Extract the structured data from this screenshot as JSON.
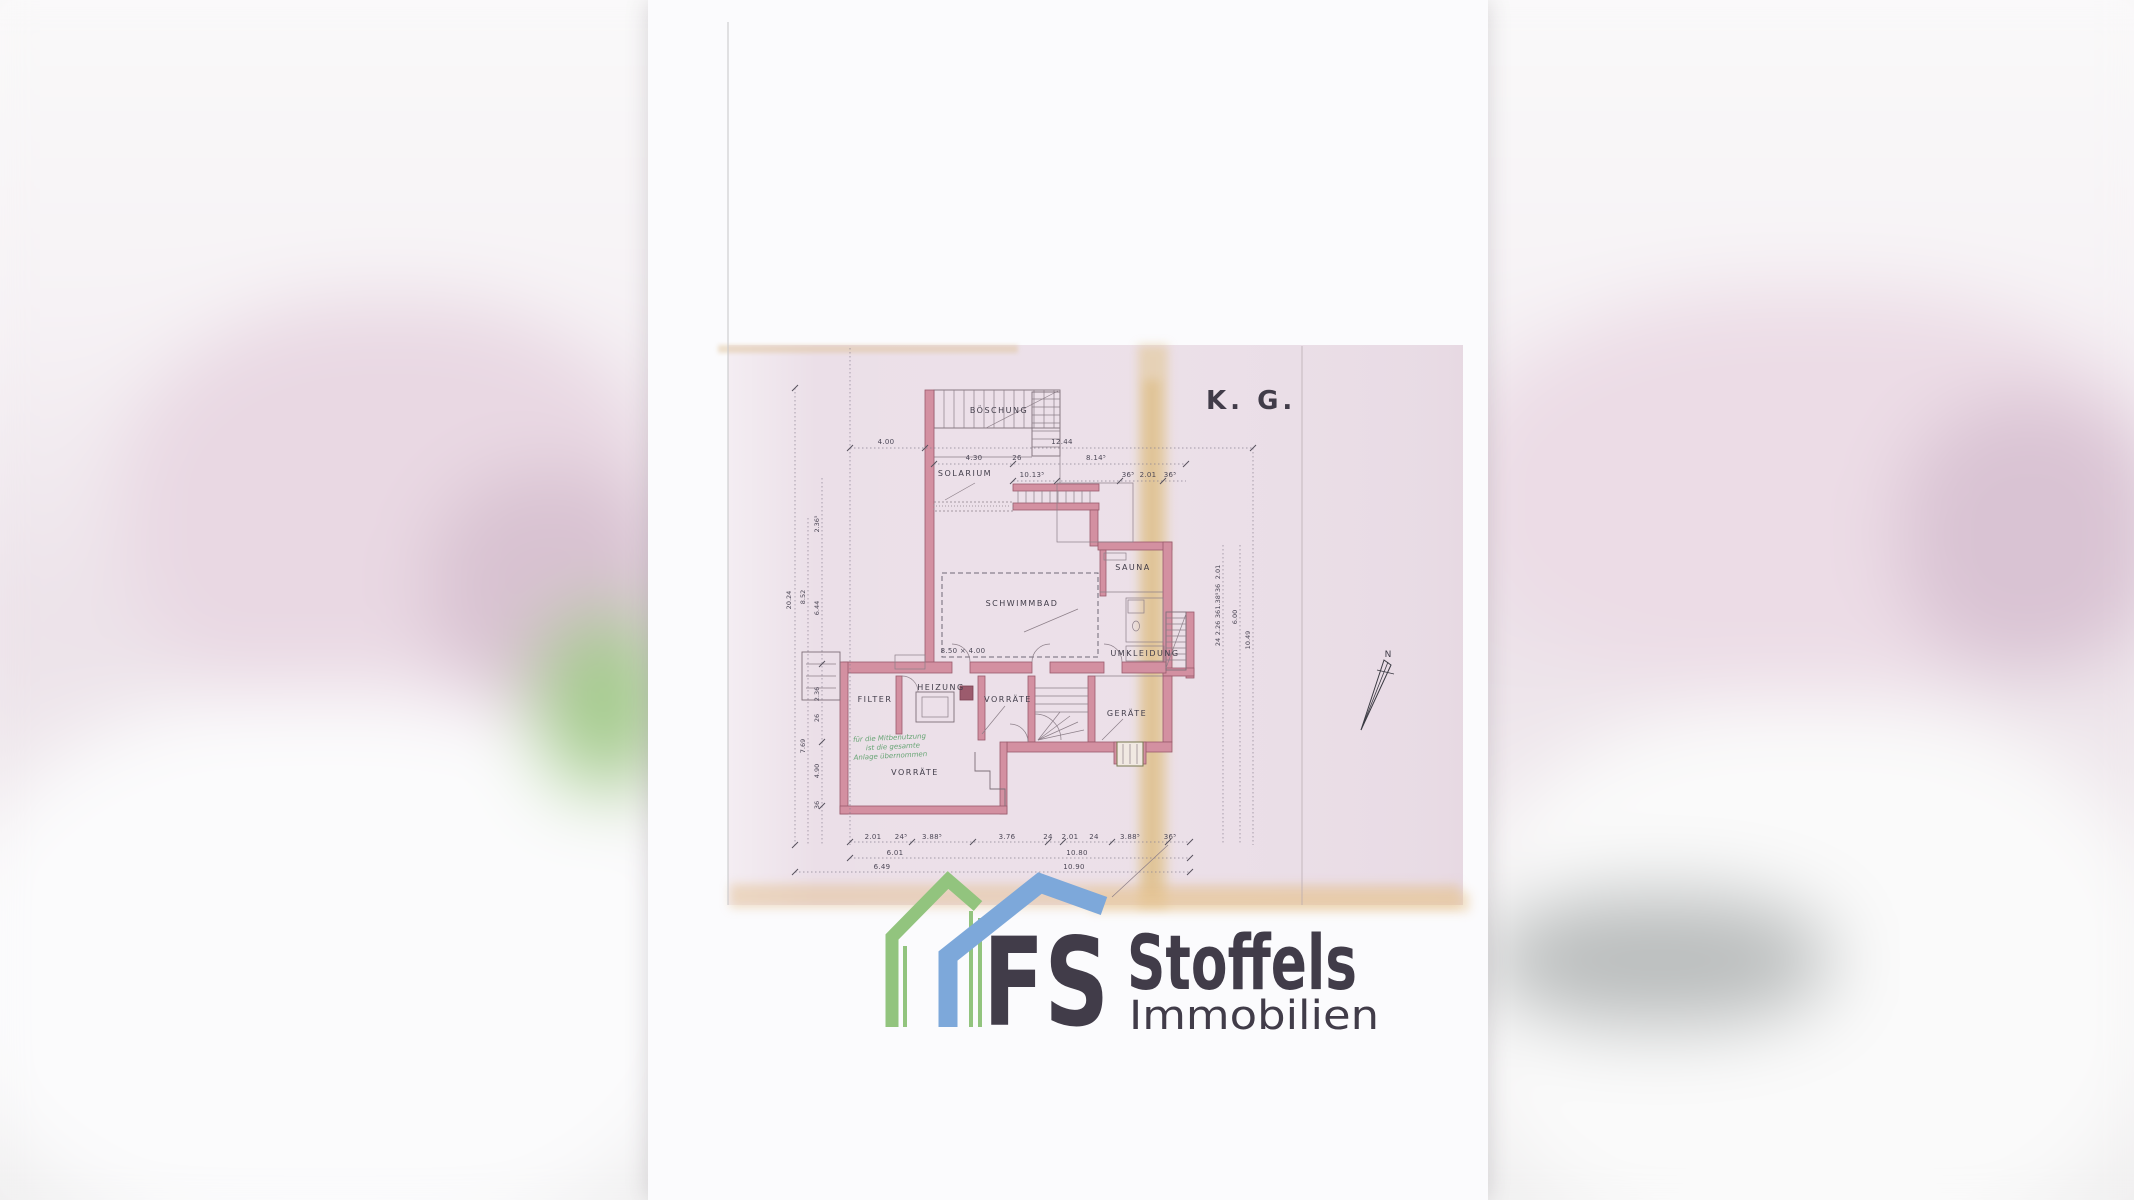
{
  "scan": {
    "floor_label": "K. G.",
    "north_label": "N",
    "rooms": {
      "boeschung": "BÖSCHUNG",
      "solarium": "SOLARIUM",
      "sauna": "SAUNA",
      "schwimmbad": "SCHWIMMBAD",
      "pool_size": "8.50 × 4.00",
      "umkleidung": "UMKLEIDUNG",
      "filter": "FILTER",
      "heizung": "HEIZUNG",
      "vorraete": "VORRÄTE",
      "geraete": "GERÄTE",
      "vorraete_unten": "VORRÄTE"
    },
    "handwriting": [
      "für die Mitbenutzung",
      "ist die gesamte",
      "Anlage übernommen"
    ],
    "dims": {
      "top": [
        "4.00",
        "12.44"
      ],
      "row2": [
        "4.30",
        "26",
        "8.14⁵"
      ],
      "row3": [
        "10.13⁵",
        "36⁵",
        "2.01",
        "36⁵"
      ],
      "left_total": "20.24",
      "left": [
        "8.52",
        "7.69"
      ],
      "left_inner": [
        "2.36⁵",
        "6.44",
        "2.36",
        "26",
        "4.90",
        "36"
      ],
      "right_inner": [
        "2.01",
        "36",
        "1.38⁵",
        "36",
        "2.26",
        "24"
      ],
      "right_mid": "6.00",
      "right_total": "10.49",
      "bottom1": [
        "2.01",
        "24⁵",
        "3.88⁵",
        "3.76",
        "24",
        "2.01",
        "24",
        "3.88⁵",
        "36⁵"
      ],
      "bottom2": [
        "6.01",
        "10.80"
      ],
      "bottom3": [
        "6.49",
        "10.90"
      ]
    }
  },
  "watermark": {
    "initials": "FS",
    "name": "Stoffels",
    "subtitle": "Immobilien"
  },
  "colors": {
    "scan_pink": "#ebdfe8",
    "wall_pink": "#d390a1",
    "stain_tan": "#e2c68e",
    "logo_green": "#92c47e",
    "logo_blue": "#7da8da",
    "logo_grey": "#9b9b9b"
  }
}
